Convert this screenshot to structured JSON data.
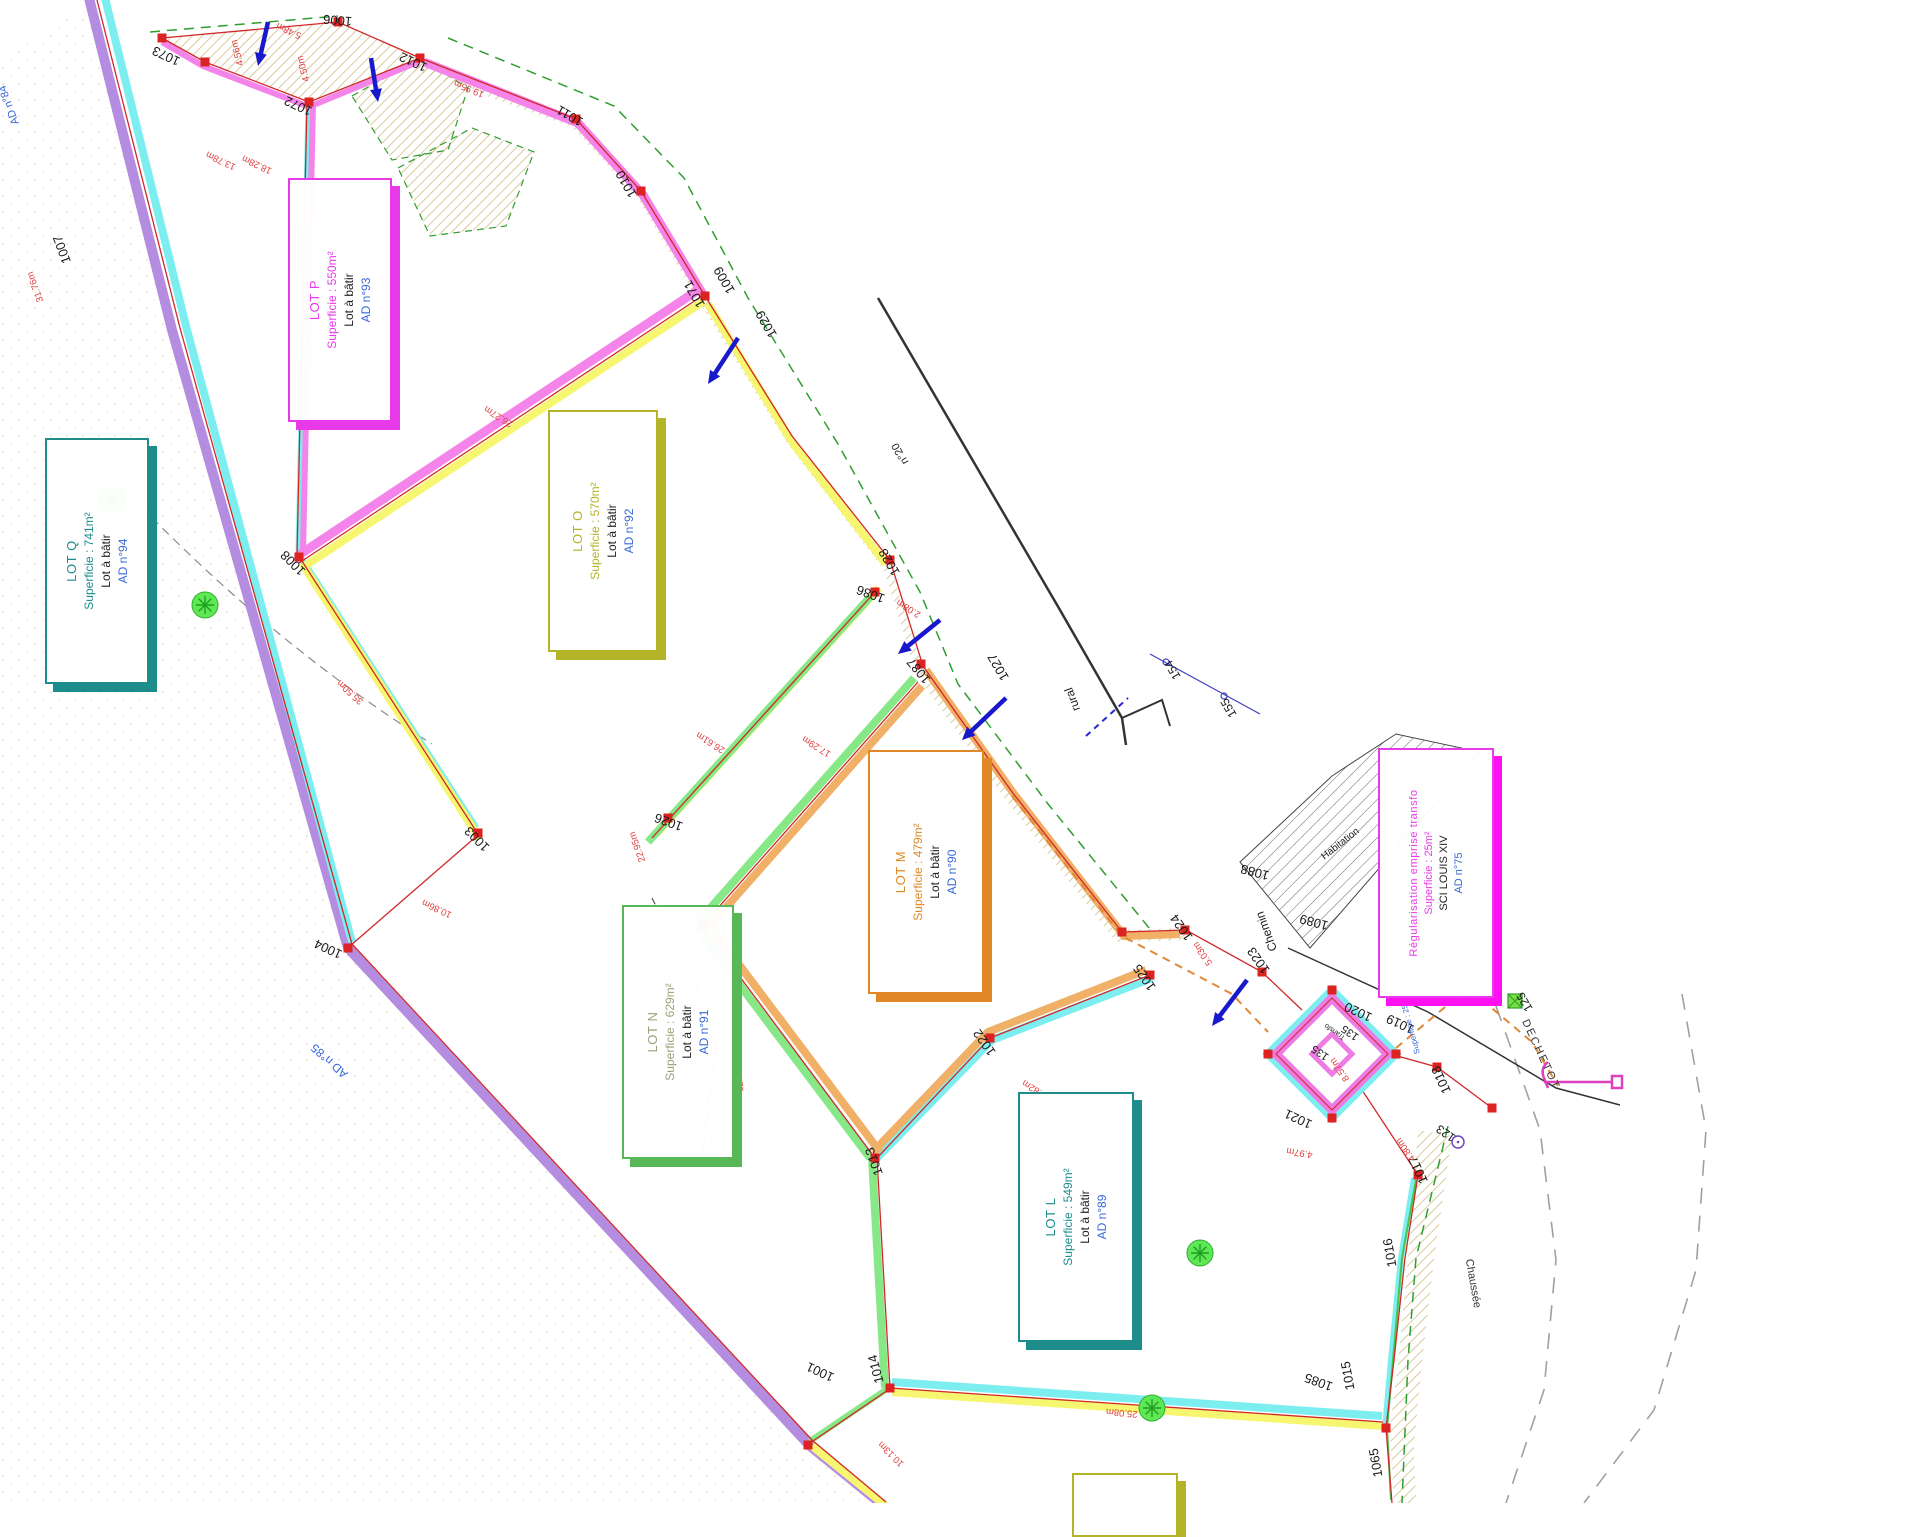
{
  "title": "Plan de division - lotissement",
  "lots": [
    {
      "name": "LOT P",
      "superficie": "Superficie : 550m²",
      "note": "Lot à bâtir",
      "ref": "AD n°93",
      "color": "#e83ae8",
      "text_color": "#e83ae8"
    },
    {
      "name": "LOT O",
      "superficie": "Superficie : 570m²",
      "note": "Lot à bâtir",
      "ref": "AD n°92",
      "color": "#b4b428",
      "text_color": "#b4b428"
    },
    {
      "name": "LOT Q",
      "superficie": "Superficie : 741m²",
      "note": "Lot à bâtir",
      "ref": "AD n°94",
      "color": "#1f8c8c",
      "text_color": "#1f8c8c"
    },
    {
      "name": "LOT M",
      "superficie": "Superficie : 479m²",
      "note": "Lot à bâtir",
      "ref": "AD n°90",
      "color": "#e08828",
      "text_color": "#e08828"
    },
    {
      "name": "LOT N",
      "superficie": "Superficie : 629m²",
      "note": "Lot à bâtir",
      "ref": "AD n°91",
      "color": "#58b858",
      "text_color": "#97a478"
    },
    {
      "name": "LOT L",
      "superficie": "Superficie : 549m²",
      "note": "Lot à bâtir",
      "ref": "AD n°89",
      "color": "#1f8c8c",
      "text_color": "#1f8c8c"
    }
  ],
  "transfo_box": {
    "line1": "Régularisation emprise transfo",
    "line2": "Superficie : 25m²",
    "line3": "SCI LOUIS XIV",
    "ref": "AD n°75",
    "color": "#e83ae8",
    "text_color": "#e83ae8"
  },
  "parcel_labels": [
    {
      "t": "1073",
      "x": 168,
      "y": 52,
      "r": 205
    },
    {
      "t": "1072",
      "x": 300,
      "y": 102,
      "r": 205
    },
    {
      "t": "1006",
      "x": 338,
      "y": 16,
      "r": 185
    },
    {
      "t": "1012",
      "x": 415,
      "y": 58,
      "r": 205
    },
    {
      "t": "1011",
      "x": 572,
      "y": 112,
      "r": 210
    },
    {
      "t": "1010",
      "x": 630,
      "y": 182,
      "r": 240
    },
    {
      "t": "1009",
      "x": 728,
      "y": 278,
      "r": 240
    },
    {
      "t": "1071",
      "x": 698,
      "y": 292,
      "r": 240
    },
    {
      "t": "1029",
      "x": 770,
      "y": 322,
      "r": 240
    },
    {
      "t": "1028",
      "x": 893,
      "y": 560,
      "r": 240
    },
    {
      "t": "1086",
      "x": 872,
      "y": 590,
      "r": 200
    },
    {
      "t": "1087",
      "x": 922,
      "y": 668,
      "r": 230
    },
    {
      "t": "1027",
      "x": 1002,
      "y": 665,
      "r": 240
    },
    {
      "t": "1007",
      "x": 66,
      "y": 248,
      "r": 250
    },
    {
      "t": "1008",
      "x": 296,
      "y": 560,
      "r": 225
    },
    {
      "t": "1003",
      "x": 480,
      "y": 836,
      "r": 225
    },
    {
      "t": "1004",
      "x": 330,
      "y": 945,
      "r": 205
    },
    {
      "t": "1026",
      "x": 670,
      "y": 818,
      "r": 200
    },
    {
      "t": "1013",
      "x": 878,
      "y": 1160,
      "r": 250
    },
    {
      "t": "1014",
      "x": 880,
      "y": 1368,
      "r": 255
    },
    {
      "t": "1001",
      "x": 822,
      "y": 1368,
      "r": 205
    },
    {
      "t": "1024",
      "x": 1185,
      "y": 925,
      "r": 235
    },
    {
      "t": "1025",
      "x": 1148,
      "y": 975,
      "r": 235
    },
    {
      "t": "1023",
      "x": 1262,
      "y": 958,
      "r": 235
    },
    {
      "t": "1022",
      "x": 988,
      "y": 1040,
      "r": 235
    },
    {
      "t": "1021",
      "x": 1300,
      "y": 1115,
      "r": 205
    },
    {
      "t": "1020",
      "x": 1360,
      "y": 1008,
      "r": 205
    },
    {
      "t": "1019",
      "x": 1402,
      "y": 1020,
      "r": 205
    },
    {
      "t": "1018",
      "x": 1445,
      "y": 1078,
      "r": 245
    },
    {
      "t": "1017",
      "x": 1422,
      "y": 1168,
      "r": 245
    },
    {
      "t": "1016",
      "x": 1394,
      "y": 1252,
      "r": 260
    },
    {
      "t": "1015",
      "x": 1352,
      "y": 1375,
      "r": 260
    },
    {
      "t": "1085",
      "x": 1320,
      "y": 1378,
      "r": 200
    },
    {
      "t": "1065",
      "x": 1380,
      "y": 1462,
      "r": 260
    },
    {
      "t": "135",
      "x": 1322,
      "y": 1050,
      "r": 215,
      "size": 11
    },
    {
      "t": "135",
      "x": 1352,
      "y": 1030,
      "r": 215,
      "size": 11
    },
    {
      "t": "1089",
      "x": 1315,
      "y": 918,
      "r": 195
    },
    {
      "t": "1088",
      "x": 1256,
      "y": 868,
      "r": 195
    },
    {
      "t": "155",
      "x": 1232,
      "y": 706,
      "r": 240,
      "size": 12
    },
    {
      "t": "154",
      "x": 1176,
      "y": 668,
      "r": 240,
      "size": 12
    },
    {
      "t": "123",
      "x": 1448,
      "y": 1130,
      "r": 215,
      "size": 12
    },
    {
      "t": "125",
      "x": 1528,
      "y": 1000,
      "r": 240,
      "size": 12
    }
  ],
  "dimension_labels": [
    {
      "t": "13.78m",
      "x": 222,
      "y": 158,
      "r": 205
    },
    {
      "t": "18.28m",
      "x": 258,
      "y": 162,
      "r": 205
    },
    {
      "t": "5.48m",
      "x": 290,
      "y": 28,
      "r": 205
    },
    {
      "t": "4.56m",
      "x": 240,
      "y": 52,
      "r": 255
    },
    {
      "t": "4.50m",
      "x": 306,
      "y": 68,
      "r": 255
    },
    {
      "t": "19.95m",
      "x": 470,
      "y": 86,
      "r": 203
    },
    {
      "t": "31.76m",
      "x": 38,
      "y": 286,
      "r": 250
    },
    {
      "t": "26.27m",
      "x": 500,
      "y": 414,
      "r": 212
    },
    {
      "t": "35.50m",
      "x": 352,
      "y": 690,
      "r": 222
    },
    {
      "t": "26.61m",
      "x": 712,
      "y": 740,
      "r": 212
    },
    {
      "t": "17.29m",
      "x": 818,
      "y": 744,
      "r": 212
    },
    {
      "t": "2.08m",
      "x": 910,
      "y": 606,
      "r": 212
    },
    {
      "t": "10.86m",
      "x": 438,
      "y": 906,
      "r": 205
    },
    {
      "t": "29.87m",
      "x": 100,
      "y": 578,
      "r": 250
    },
    {
      "t": "22.95m",
      "x": 640,
      "y": 846,
      "r": 250
    },
    {
      "t": "12.78m",
      "x": 742,
      "y": 1076,
      "r": 265
    },
    {
      "t": "17.82m",
      "x": 1038,
      "y": 1088,
      "r": 212
    },
    {
      "t": "5.03m",
      "x": 1205,
      "y": 952,
      "r": 235
    },
    {
      "t": "8.57m",
      "x": 1342,
      "y": 1068,
      "r": 235
    },
    {
      "t": "4.80m",
      "x": 1408,
      "y": 1148,
      "r": 235
    },
    {
      "t": "4.97m",
      "x": 1300,
      "y": 1150,
      "r": 190
    },
    {
      "t": "25.08m",
      "x": 1122,
      "y": 1410,
      "r": 185
    },
    {
      "t": "10.13m",
      "x": 893,
      "y": 1452,
      "r": 225
    }
  ],
  "misc_labels": [
    {
      "t": "n°20",
      "x": 903,
      "y": 452,
      "r": 240,
      "size": 11,
      "color": "#222222"
    },
    {
      "t": "rural",
      "x": 1076,
      "y": 698,
      "r": 250,
      "size": 12,
      "color": "#222222"
    },
    {
      "t": "Chemin",
      "x": 1270,
      "y": 930,
      "r": 250,
      "size": 12,
      "color": "#222222"
    },
    {
      "t": "DECHETOT",
      "x": 1538,
      "y": 1056,
      "r": 65,
      "size": 11,
      "color": "#333333",
      "ls": 2
    },
    {
      "t": "Chaussée",
      "x": 1470,
      "y": 1284,
      "r": 80,
      "size": 11,
      "color": "#333333"
    },
    {
      "t": "Habitation",
      "x": 1342,
      "y": 846,
      "r": -38,
      "size": 10,
      "color": "#222222"
    },
    {
      "t": "AD n°85",
      "x": 332,
      "y": 1058,
      "r": 222,
      "size": 12,
      "color": "#3868d8"
    },
    {
      "t": "AD n°84",
      "x": 12,
      "y": 104,
      "r": 250,
      "size": 11,
      "color": "#3868d8"
    },
    {
      "t": "Superficie : 25m²",
      "x": 1412,
      "y": 1024,
      "r": 255,
      "size": 8,
      "color": "#3868d8"
    },
    {
      "t": "Transfo",
      "x": 1336,
      "y": 1030,
      "r": 215,
      "size": 7,
      "color": "#222222"
    }
  ],
  "colors": {
    "purple_band": "#b48ce0",
    "cyan_band": "#7deef0",
    "pink_band": "#f584ea",
    "yellow_band": "#f6f670",
    "green_band": "#86e886",
    "orange_band": "#f0b068",
    "red_line": "#d02828",
    "red_marker": "#dd2222",
    "blue_arrow": "#1818cc",
    "dim_red": "#e04040",
    "blue_text": "#3868d8",
    "talus_hatch": "#c9b775",
    "road_gray": "#a0a0a0",
    "green_dash": "#2f9e2f",
    "tree_green": "#5fe855"
  }
}
